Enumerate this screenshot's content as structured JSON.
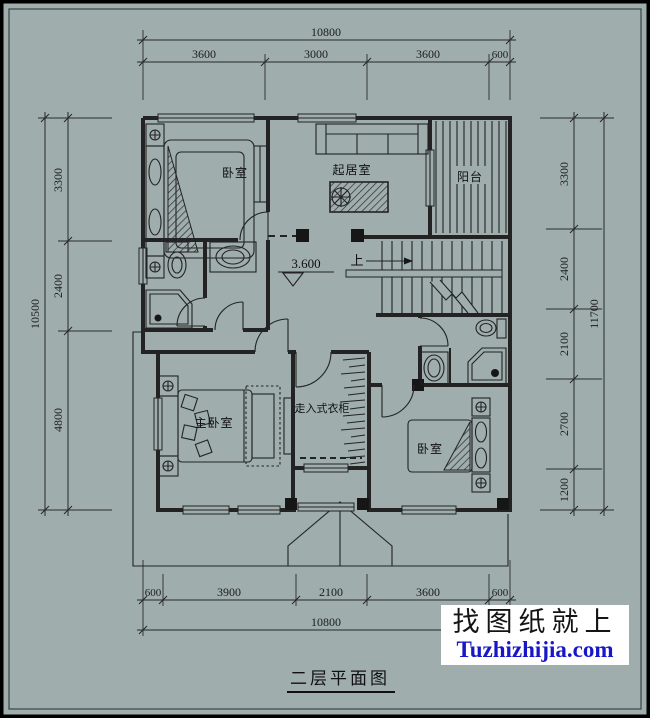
{
  "title": {
    "text": "二层平面图"
  },
  "watermark": {
    "line1": "找图纸就上",
    "line2": "Tuzhizhijia.com"
  },
  "rooms": {
    "bedroom_top_left": "卧室",
    "living_room": "起居室",
    "balcony": "阳台",
    "master_bedroom": "主卧室",
    "walk_in_closet": "走入式衣柜",
    "bedroom_bottom_right": "卧室"
  },
  "annotations": {
    "elevation": "3.600",
    "stairs_up": "上"
  },
  "dimensions": {
    "top": {
      "total": "10800",
      "segments": [
        "3600",
        "3000",
        "3600",
        "600"
      ]
    },
    "bottom": {
      "total": "10800",
      "segments": [
        "600",
        "3900",
        "2100",
        "3600",
        "600"
      ]
    },
    "left": {
      "total": "10500",
      "segments": [
        "3300",
        "2400",
        "4800"
      ]
    },
    "right": {
      "total": "11700",
      "segments": [
        "3300",
        "2400",
        "2100",
        "2700",
        "1200"
      ]
    }
  },
  "colors": {
    "background": "#9fadad",
    "line": "#232323",
    "watermark_link": "#1717c9",
    "watermark_box": "#ffffff"
  }
}
